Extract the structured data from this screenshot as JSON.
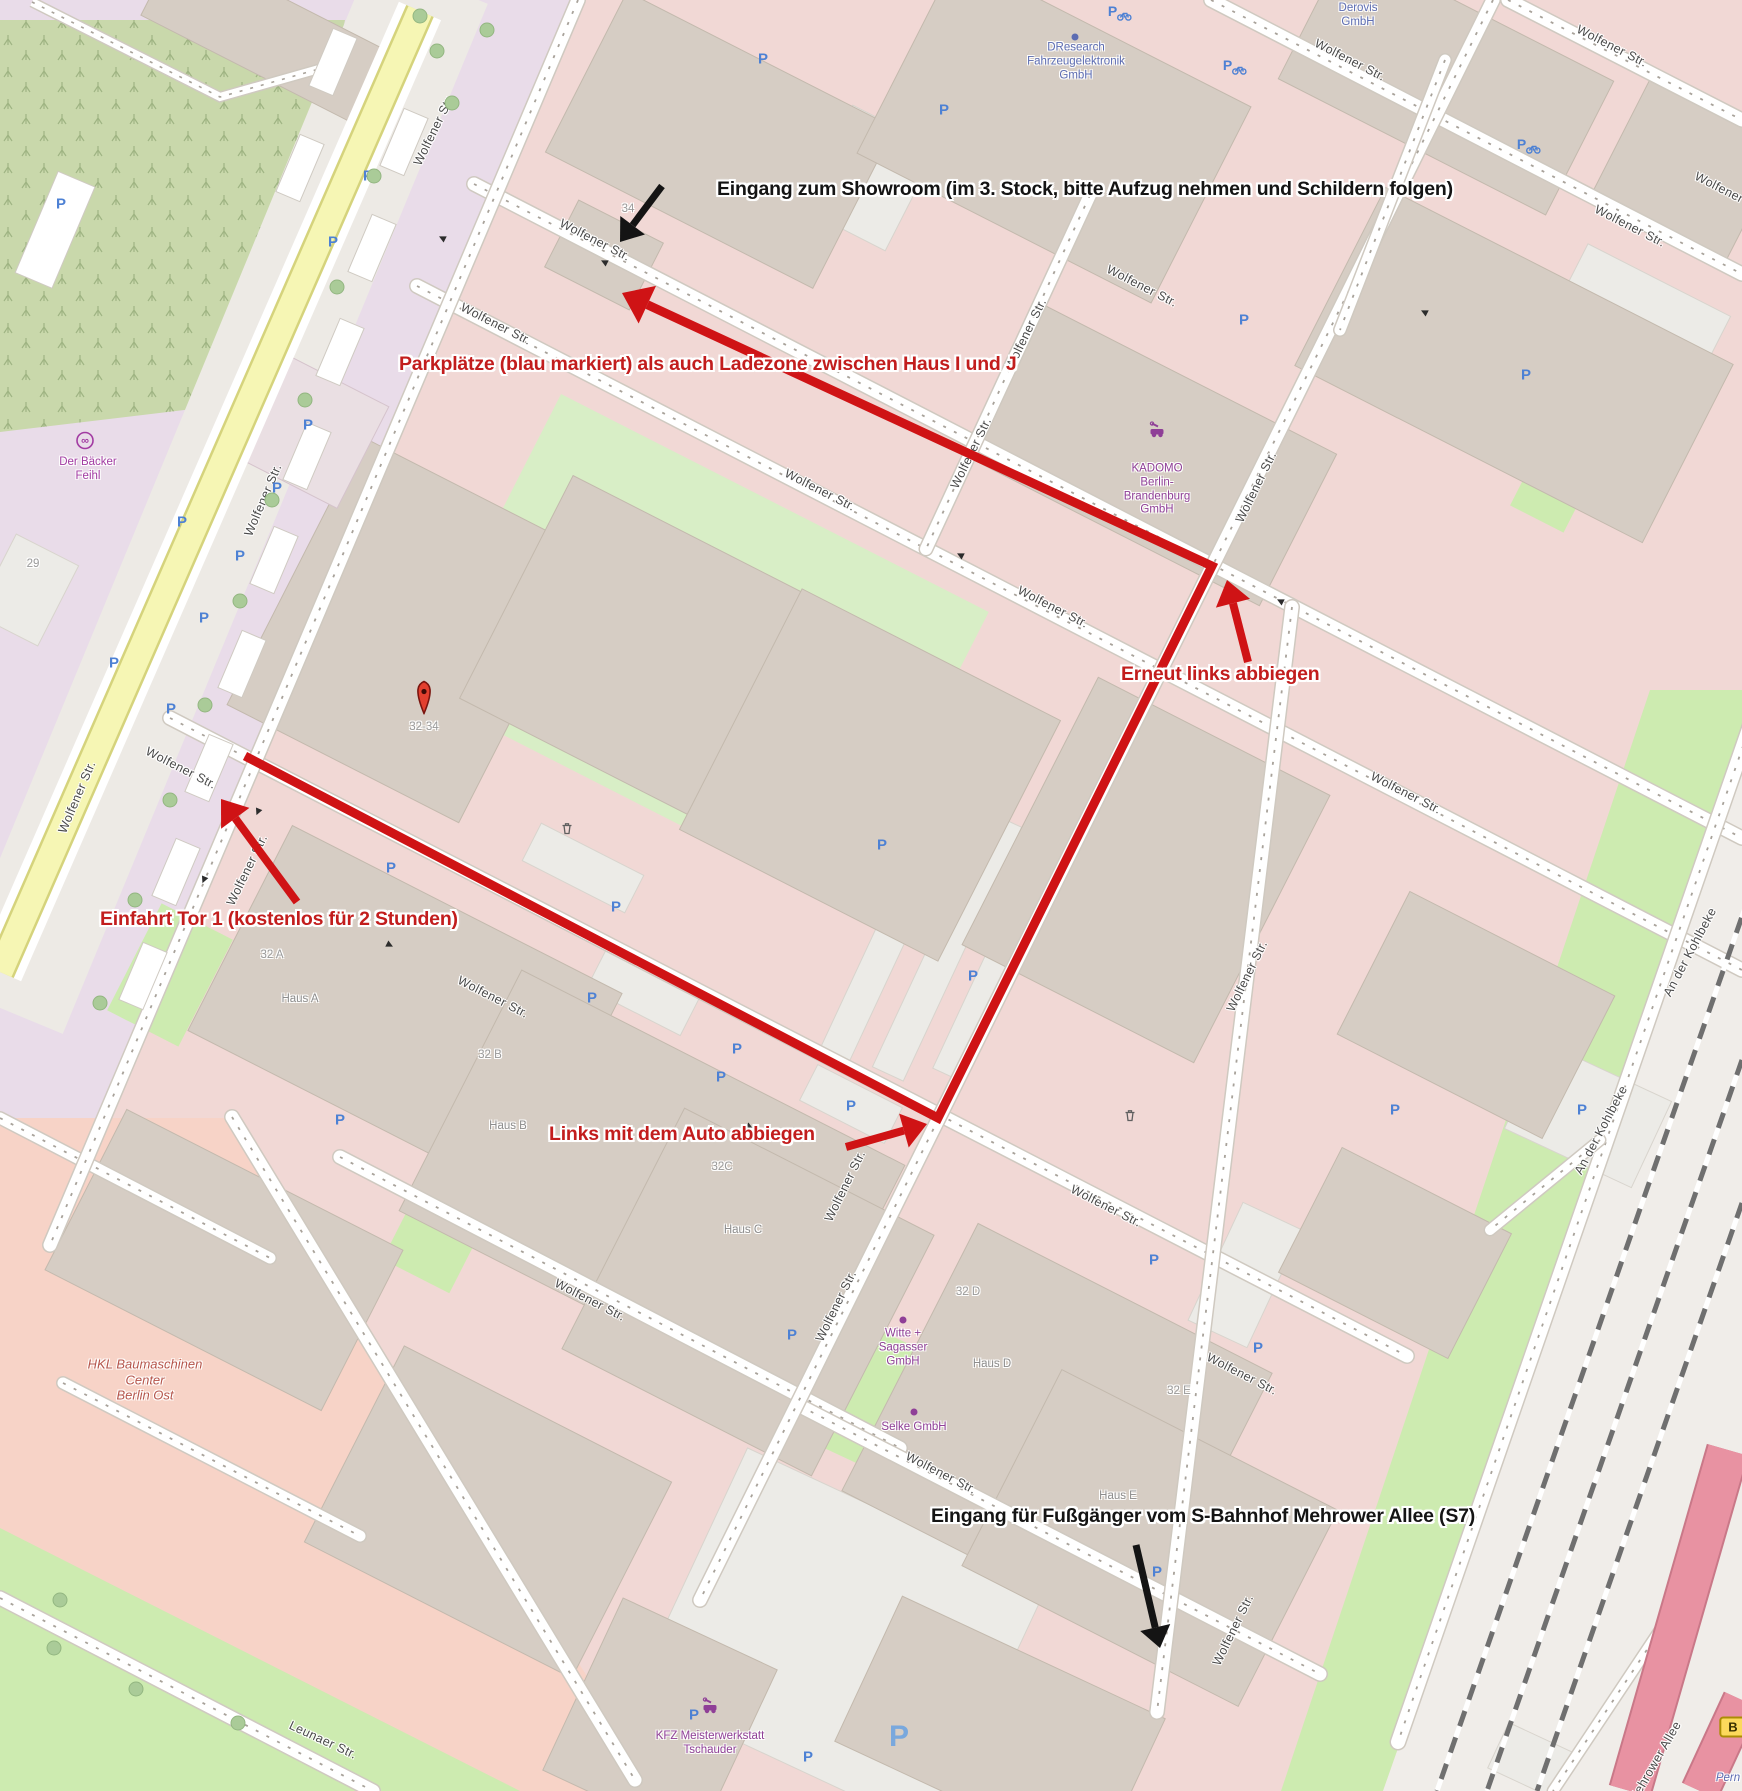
{
  "canvas": {
    "width": 1742,
    "height": 1791
  },
  "palette": {
    "route_red": "#cf1315",
    "annotation_red": "#c21d1d",
    "annotation_black": "#141414",
    "parking_blue": "#4d81d4",
    "poi_purple": "#8f3f97",
    "office_blue": "#5c6cb2",
    "shop_magenta": "#a23ba2",
    "industrial_name": "#b5554b",
    "grass_green": "#cdebb0",
    "road_yellow": "#f6f6b4",
    "road_pink": "#e892a2"
  },
  "annotations": {
    "showroom": {
      "text": "Eingang zum Showroom (im 3. Stock, bitte Aufzug nehmen und Schildern folgen)",
      "x": 717,
      "y": 178,
      "color": "black"
    },
    "parkplaetze": {
      "text": "Parkplätze (blau markiert) als auch Ladezone zwischen Haus I und J",
      "x": 399,
      "y": 353,
      "color": "red"
    },
    "erneut": {
      "text": "Erneut links abbiegen",
      "x": 1121,
      "y": 663,
      "color": "red"
    },
    "einfahrt": {
      "text": "Einfahrt Tor 1 (kostenlos für 2 Stunden)",
      "x": 100,
      "y": 908,
      "color": "red"
    },
    "links": {
      "text": "Links mit dem Auto abbiegen",
      "x": 549,
      "y": 1123,
      "color": "red"
    },
    "fussgaenger": {
      "text": "Eingang für Fußgänger vom S-Bahnhof Mehrower Allee (S7)",
      "x": 931,
      "y": 1505,
      "color": "black"
    }
  },
  "route": {
    "color": "#cf1315",
    "width": 9,
    "points": [
      [
        245,
        756
      ],
      [
        938,
        1118
      ],
      [
        1212,
        566
      ],
      [
        622,
        293
      ]
    ]
  },
  "arrows": [
    {
      "name": "showroom-arrow",
      "color": "#141414",
      "w": 7,
      "x1": 662,
      "y1": 186,
      "x2": 620,
      "y2": 242
    },
    {
      "name": "pedestrian-arrow",
      "color": "#141414",
      "w": 7,
      "x1": 1136,
      "y1": 1545,
      "x2": 1160,
      "y2": 1648
    },
    {
      "name": "einfahrt-arrow",
      "color": "#cf1315",
      "w": 8,
      "x1": 297,
      "y1": 902,
      "x2": 221,
      "y2": 799
    },
    {
      "name": "links-arrow",
      "color": "#cf1315",
      "w": 8,
      "x1": 846,
      "y1": 1147,
      "x2": 927,
      "y2": 1124
    },
    {
      "name": "erneut-arrow",
      "color": "#cf1315",
      "w": 8,
      "x1": 1248,
      "y1": 662,
      "x2": 1227,
      "y2": 580
    }
  ],
  "street_labels": [
    {
      "text": "Wolfener Str.",
      "x": 434,
      "y": 130,
      "rot": -64
    },
    {
      "text": "Wolfener Str.",
      "x": 263,
      "y": 500,
      "rot": -67
    },
    {
      "text": "Wolfener Str.",
      "x": 77,
      "y": 797,
      "rot": -67
    },
    {
      "text": "Wolfener Str.",
      "x": 595,
      "y": 240,
      "rot": 27
    },
    {
      "text": "Wolfener Str.",
      "x": 1142,
      "y": 286,
      "rot": 27
    },
    {
      "text": "Wolfener Str.",
      "x": 1630,
      "y": 226,
      "rot": 27
    },
    {
      "text": "Wolfener Str.",
      "x": 1350,
      "y": 60,
      "rot": 27
    },
    {
      "text": "Wolfener Str.",
      "x": 1612,
      "y": 46,
      "rot": 27
    },
    {
      "text": "Wolfener Str.",
      "x": 1730,
      "y": 193,
      "rot": 27
    },
    {
      "text": "Wolfener Str.",
      "x": 496,
      "y": 324,
      "rot": 27
    },
    {
      "text": "Wolfener Str.",
      "x": 820,
      "y": 490,
      "rot": 27
    },
    {
      "text": "Wolfener Str.",
      "x": 1053,
      "y": 607,
      "rot": 27
    },
    {
      "text": "Wolfener Str.",
      "x": 1406,
      "y": 793,
      "rot": 27
    },
    {
      "text": "Wolfener Str.",
      "x": 181,
      "y": 768,
      "rot": 27
    },
    {
      "text": "Wolfener Str.",
      "x": 247,
      "y": 870,
      "rot": -64
    },
    {
      "text": "Wolfener Str.",
      "x": 493,
      "y": 997,
      "rot": 27
    },
    {
      "text": "Wolfener Str.",
      "x": 1106,
      "y": 1206,
      "rot": 27
    },
    {
      "text": "Wolfener Str.",
      "x": 1242,
      "y": 1374,
      "rot": 27
    },
    {
      "text": "Wolfener Str.",
      "x": 590,
      "y": 1300,
      "rot": 27
    },
    {
      "text": "Wolfener Str.",
      "x": 941,
      "y": 1473,
      "rot": 27
    },
    {
      "text": "Wolfener Str.",
      "x": 1026,
      "y": 334,
      "rot": -64
    },
    {
      "text": "Wolfener Str.",
      "x": 971,
      "y": 453,
      "rot": -64
    },
    {
      "text": "Wolfener Str.",
      "x": 1256,
      "y": 487,
      "rot": -64
    },
    {
      "text": "Wolfener Str.",
      "x": 845,
      "y": 1186,
      "rot": -64
    },
    {
      "text": "Wolfener Str.",
      "x": 836,
      "y": 1306,
      "rot": -64
    },
    {
      "text": "Wolfener Str.",
      "x": 1247,
      "y": 976,
      "rot": -64
    },
    {
      "text": "Wolfener Str.",
      "x": 1233,
      "y": 1630,
      "rot": -64
    },
    {
      "text": "An der Kohlbeke",
      "x": 1690,
      "y": 952,
      "rot": -62
    },
    {
      "text": "An der Kohlbeke",
      "x": 1601,
      "y": 1130,
      "rot": -62
    },
    {
      "text": "Leunaer Str.",
      "x": 323,
      "y": 1740,
      "rot": 25
    },
    {
      "text": "Mehrower Allee",
      "x": 1655,
      "y": 1762,
      "rot": -60
    }
  ],
  "place_labels": [
    {
      "text": "Der Bäcker\nFeihl",
      "x": 88,
      "y": 470,
      "color": "shop"
    },
    {
      "text": "DResearch\nFahrzeugelektronik\nGmbH",
      "x": 1076,
      "y": 62,
      "color": "office"
    },
    {
      "text": "Derovis\nGmbH",
      "x": 1358,
      "y": 16,
      "color": "office"
    },
    {
      "text": "KADOMO\nBerlin-\nBrandenburg\nGmbH",
      "x": 1157,
      "y": 490,
      "color": "poi"
    },
    {
      "text": "Witte +\nSagasser\nGmbH",
      "x": 903,
      "y": 1348,
      "color": "poi"
    },
    {
      "text": "Selke GmbH",
      "x": 914,
      "y": 1428,
      "color": "poi"
    },
    {
      "text": "KFZ Meisterwerkstatt\nTschauder",
      "x": 710,
      "y": 1744,
      "color": "poi"
    },
    {
      "text": "HKL Baumaschinen\nCenter\nBerlin Ost",
      "x": 145,
      "y": 1380,
      "color": "industrial",
      "italic": true,
      "size": 13
    },
    {
      "text": "Haus A",
      "x": 300,
      "y": 1000,
      "color": "haus"
    },
    {
      "text": "Haus B",
      "x": 508,
      "y": 1127,
      "color": "haus"
    },
    {
      "text": "Haus C",
      "x": 743,
      "y": 1231,
      "color": "haus"
    },
    {
      "text": "Haus D",
      "x": 992,
      "y": 1365,
      "color": "haus"
    },
    {
      "text": "Haus E",
      "x": 1118,
      "y": 1497,
      "color": "haus"
    },
    {
      "text": "32 A",
      "x": 272,
      "y": 956,
      "color": "num"
    },
    {
      "text": "32 B",
      "x": 490,
      "y": 1056,
      "color": "num"
    },
    {
      "text": "32C",
      "x": 722,
      "y": 1168,
      "color": "num"
    },
    {
      "text": "32 D",
      "x": 968,
      "y": 1293,
      "color": "num"
    },
    {
      "text": "32 E",
      "x": 1179,
      "y": 1392,
      "color": "num"
    },
    {
      "text": "34",
      "x": 628,
      "y": 210,
      "color": "num"
    },
    {
      "text": "29",
      "x": 33,
      "y": 565,
      "color": "num"
    },
    {
      "text": "32-34",
      "x": 424,
      "y": 728,
      "color": "num"
    },
    {
      "text": "Pern",
      "x": 1728,
      "y": 1779,
      "color": "water",
      "italic": true
    }
  ],
  "marker_32_34": {
    "x": 424,
    "y": 700
  },
  "badge_b": {
    "label": "B",
    "x": 1733,
    "y": 1727
  },
  "poi_icons": [
    {
      "type": "pretzel-icon",
      "x": 85,
      "y": 443
    },
    {
      "type": "car-repair-icon",
      "x": 1157,
      "y": 432
    },
    {
      "type": "car-repair-icon",
      "x": 710,
      "y": 1708
    }
  ],
  "poi_dots": [
    {
      "x": 1075,
      "y": 37,
      "color": "office"
    },
    {
      "x": 903,
      "y": 1320,
      "color": "poi"
    },
    {
      "x": 914,
      "y": 1412,
      "color": "poi"
    }
  ],
  "parking": [
    [
      368,
      176
    ],
    [
      333,
      242
    ],
    [
      308,
      425
    ],
    [
      277,
      488
    ],
    [
      182,
      522
    ],
    [
      240,
      556
    ],
    [
      204,
      618
    ],
    [
      114,
      663
    ],
    [
      171,
      709
    ],
    [
      61,
      204
    ],
    [
      763,
      59
    ],
    [
      944,
      110
    ],
    [
      1244,
      320
    ],
    [
      1526,
      375
    ],
    [
      616,
      907
    ],
    [
      592,
      998
    ],
    [
      391,
      868
    ],
    [
      340,
      1120
    ],
    [
      882,
      845
    ],
    [
      973,
      976
    ],
    [
      737,
      1049
    ],
    [
      721,
      1077
    ],
    [
      851,
      1106
    ],
    [
      792,
      1335
    ],
    [
      694,
      1715
    ],
    [
      808,
      1757
    ],
    [
      1154,
      1260
    ],
    [
      1258,
      1348
    ],
    [
      1395,
      1110
    ],
    [
      1582,
      1110
    ],
    [
      1157,
      1572
    ]
  ],
  "parking_big": [
    [
      899,
      1737
    ]
  ],
  "bike_parking": [
    [
      1120,
      12
    ],
    [
      1235,
      66
    ],
    [
      1529,
      145
    ]
  ],
  "trash": [
    [
      567,
      831
    ],
    [
      1130,
      1118
    ]
  ],
  "trees": [
    [
      437,
      51
    ],
    [
      420,
      16
    ],
    [
      487,
      30
    ],
    [
      452,
      103
    ],
    [
      374,
      176
    ],
    [
      337,
      287
    ],
    [
      305,
      400
    ],
    [
      272,
      500
    ],
    [
      240,
      601
    ],
    [
      205,
      705
    ],
    [
      170,
      800
    ],
    [
      135,
      900
    ],
    [
      100,
      1003
    ],
    [
      54,
      1648
    ],
    [
      136,
      1689
    ],
    [
      238,
      1723
    ],
    [
      60,
      1600
    ]
  ],
  "oneway": [
    [
      442,
      238,
      207
    ],
    [
      604,
      262,
      207
    ],
    [
      960,
      555,
      207
    ],
    [
      1280,
      601,
      207
    ],
    [
      1424,
      312,
      207
    ],
    [
      390,
      945,
      27
    ],
    [
      750,
      1127,
      27
    ],
    [
      204,
      880,
      113
    ],
    [
      258,
      812,
      113
    ]
  ]
}
